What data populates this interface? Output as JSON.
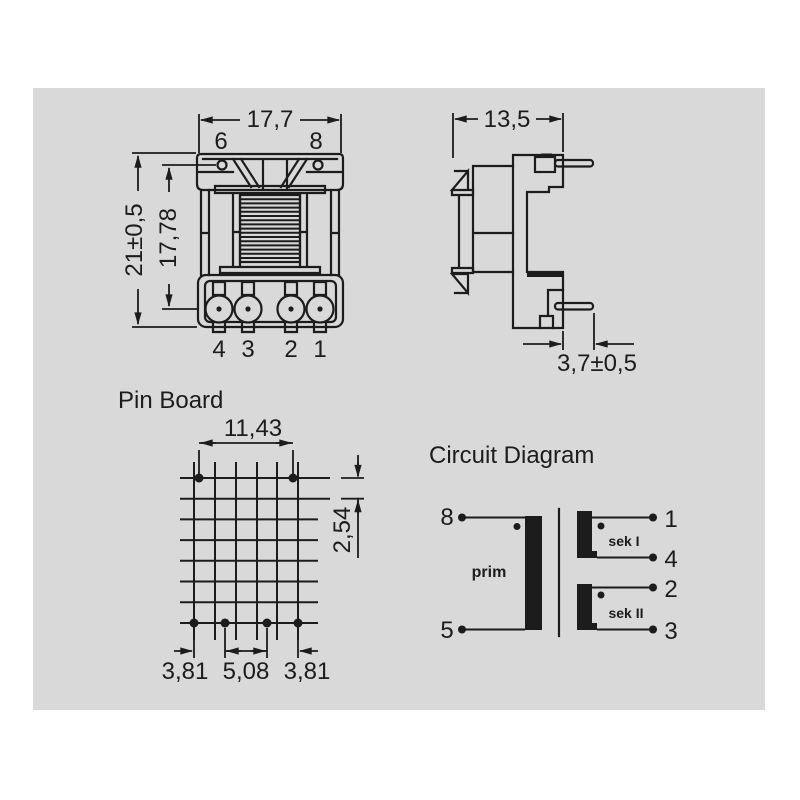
{
  "colors": {
    "canvas": "#d9d9d9",
    "ink": "#1c1c1c"
  },
  "front_view": {
    "width_dim": "17,7",
    "height_dim": "21±0,5",
    "pin_span_dim": "17,78",
    "top_pin_labels": [
      "6",
      "8"
    ],
    "bottom_pin_labels": [
      "4",
      "3",
      "2",
      "1"
    ]
  },
  "side_view": {
    "width_dim": "13,5",
    "pin_offset_dim": "3,7±0,5"
  },
  "pin_board": {
    "title": "Pin Board",
    "top_span_dim": "11,43",
    "grid_pitch_dim": "2,54",
    "bottom_dims": [
      "3,81",
      "5,08",
      "3,81"
    ]
  },
  "circuit_diagram": {
    "title": "Circuit Diagram",
    "primary_label": "prim",
    "primary_pins": [
      "8",
      "5"
    ],
    "sec1_label": "sek I",
    "sec1_pins": [
      "1",
      "4"
    ],
    "sec2_label": "sek II",
    "sec2_pins": [
      "2",
      "3"
    ]
  }
}
